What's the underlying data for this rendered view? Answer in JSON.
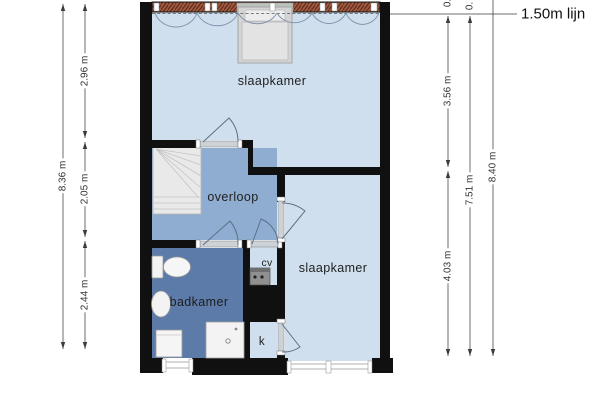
{
  "rooms": {
    "bedroom_top": {
      "label": "slaapkamer"
    },
    "landing": {
      "label": "overloop"
    },
    "bathroom": {
      "label": "badkamer"
    },
    "bedroom_bottom": {
      "label": "slaapkamer"
    },
    "cv_closet": {
      "label": "cv"
    },
    "closet": {
      "label": "k"
    }
  },
  "dimensions": {
    "left": {
      "total": "8.36 m",
      "top": "2.96 m",
      "middle": "2.05 m",
      "bottom": "2.44 m"
    },
    "right": {
      "upper": "3.56 m",
      "lower": "4.03 m",
      "inner_total": "7.51 m",
      "outer_total": "8.40 m",
      "top_fragment_1": "0.",
      "top_fragment_2": "0."
    }
  },
  "annotations": {
    "height_line_label": "1.50m lijn"
  },
  "colors": {
    "wall": "#101010",
    "room_light": "#cfdfee",
    "landing": "#8fadd0",
    "bathroom": "#5c7ba8",
    "roof_hatch": "#a05a40",
    "dimension": "#3c3c3c"
  },
  "icons": {
    "bed": "bed-icon",
    "stairs": "stairs-icon",
    "toilet": "toilet-icon",
    "sink": "sink-icon",
    "shower": "shower-icon",
    "washing_machine": "washing-machine-icon",
    "boiler": "cv-boiler-icon"
  }
}
